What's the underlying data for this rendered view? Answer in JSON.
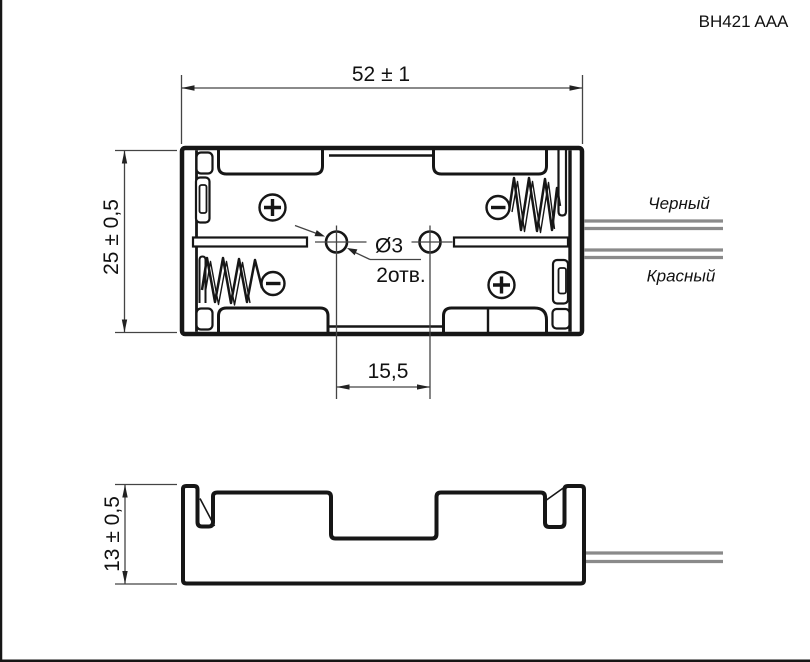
{
  "title": "BH421 AAA",
  "dimensions": {
    "body_width": "52 ± 1",
    "body_depth": "25 ± 0,5",
    "body_height": "13 ± 0,5",
    "hole_spacing": "15,5",
    "hole_diameter": "Ø3",
    "hole_count": "2отв."
  },
  "wires": {
    "black_label": "Черный",
    "red_label": "Красный"
  },
  "contacts": {
    "positive_symbol": "+",
    "negative_symbol": "−"
  },
  "colors": {
    "line": "#161616",
    "dimension": "#444444",
    "wire": "#8a8a8a",
    "background": "#ffffff"
  }
}
